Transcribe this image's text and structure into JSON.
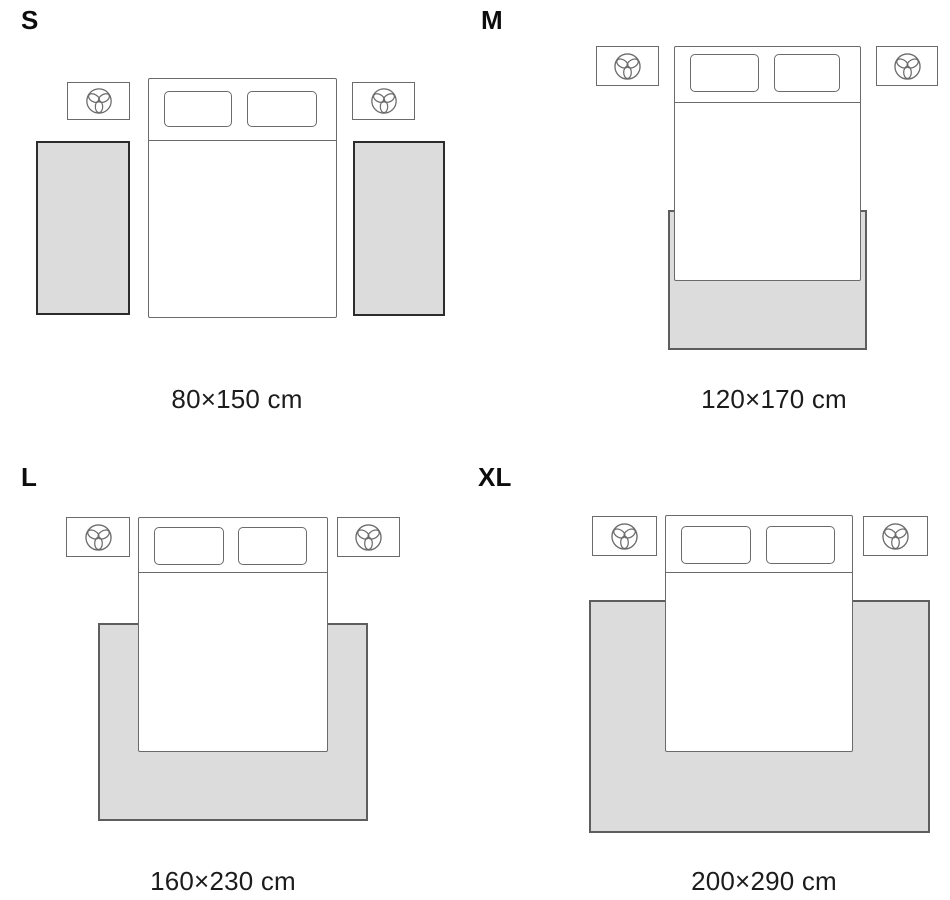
{
  "colors": {
    "background": "#ffffff",
    "rug_fill": "#dcdcdc",
    "rug_border": "#5e5e5e",
    "rug_border_dark": "#2c2c2c",
    "furniture_border": "#6b6b6b",
    "label_color": "#0d0d0d",
    "caption_color": "#1c1c1c"
  },
  "icons": {
    "nightstand_icon": "flower-icon"
  },
  "sizes": [
    {
      "label": "S",
      "caption": "80×150 cm",
      "rug_placement": "two side runners beside bed"
    },
    {
      "label": "M",
      "caption": "120×170 cm",
      "rug_placement": "under lower part of bed"
    },
    {
      "label": "L",
      "caption": "160×230 cm",
      "rug_placement": "under lower part of bed"
    },
    {
      "label": "XL",
      "caption": "200×290 cm",
      "rug_placement": "under lower part of bed"
    }
  ]
}
